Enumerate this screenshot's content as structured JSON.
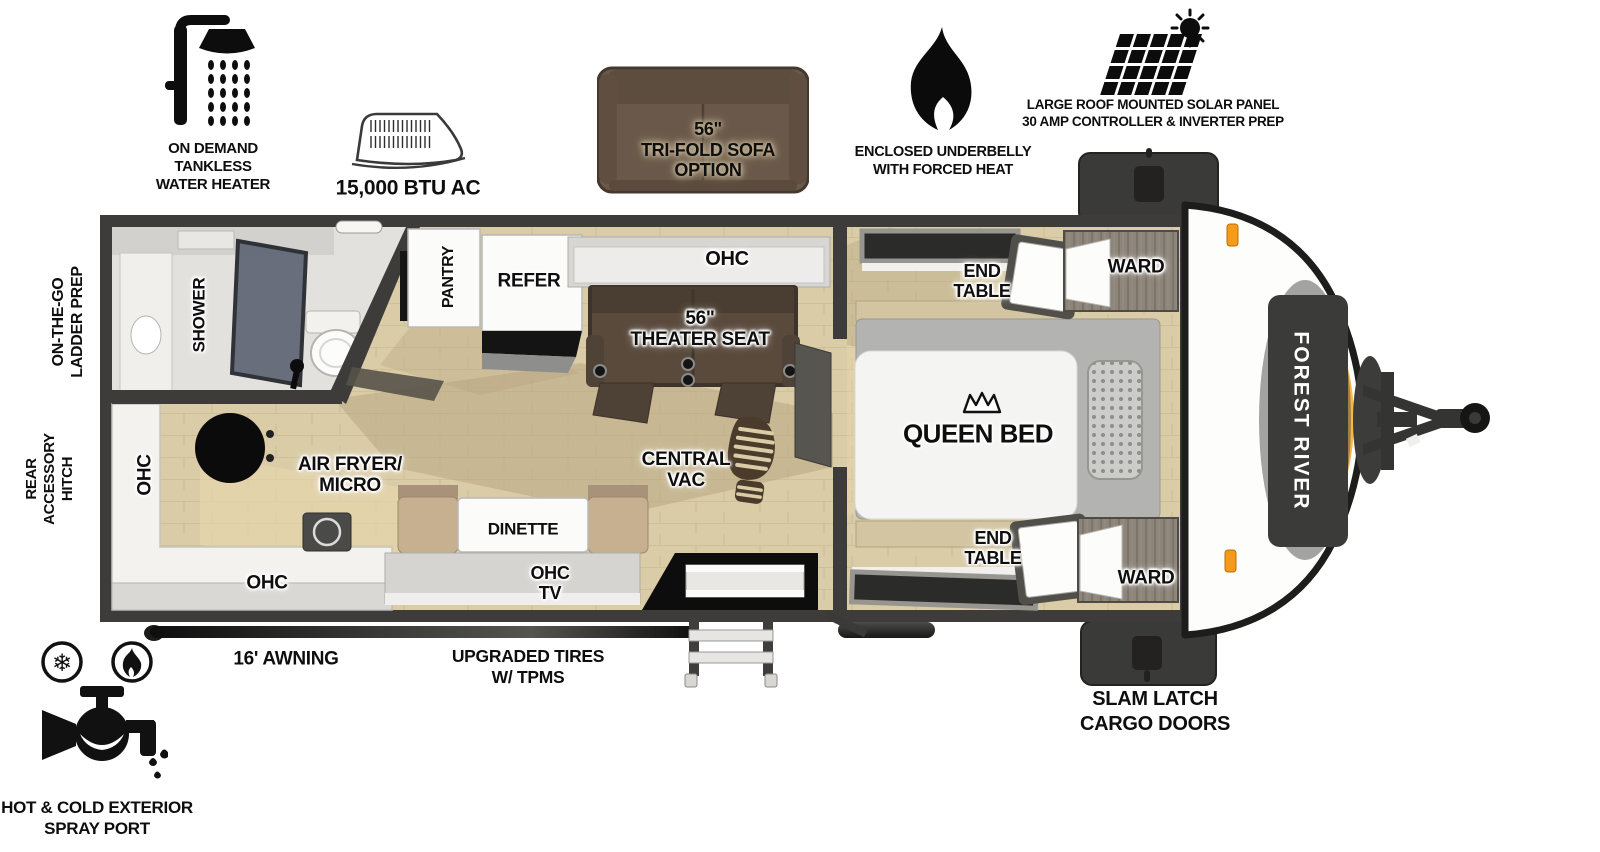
{
  "features_top": [
    {
      "name": "water-heater",
      "label": "ON DEMAND\nTANKLESS\nWATER HEATER"
    },
    {
      "name": "air-conditioner",
      "label": "15,000 BTU AC"
    },
    {
      "name": "trifold-sofa-option",
      "label": "56\"\nTRI-FOLD SOFA\nOPTION"
    },
    {
      "name": "enclosed-underbelly",
      "label": "ENCLOSED UNDERBELLY\nWITH FORCED HEAT"
    },
    {
      "name": "solar-panel",
      "label": "LARGE ROOF MOUNTED SOLAR PANEL\n30 AMP CONTROLLER & INVERTER PREP"
    }
  ],
  "side_labels": {
    "ladder_prep": "ON-THE-GO\nLADDER PREP",
    "rear_hitch": "REAR\nACCESSORY\nHITCH"
  },
  "rooms": {
    "shower": "SHOWER",
    "pantry": "PANTRY",
    "refer": "REFER",
    "ohc_top": "OHC",
    "theater_seat": "56\"\nTHEATER SEAT",
    "ohc_left": "OHC",
    "air_fryer_micro": "AIR FRYER/\nMICRO",
    "ohc_bottom": "OHC",
    "dinette": "DINETTE",
    "ohc_tv": "OHC\nTV",
    "central_vac": "CENTRAL\nVAC",
    "queen_bed": "QUEEN BED",
    "end_table_top": "END\nTABLE",
    "ward_top": "WARD",
    "end_table_bottom": "END\nTABLE",
    "ward_bottom": "WARD"
  },
  "brand_badge": "FOREST RIVER",
  "bottom_labels": {
    "awning": "16' AWNING",
    "tires": "UPGRADED TIRES\nW/ TPMS",
    "cargo_doors": "SLAM LATCH\nCARGO DOORS",
    "spray_port": "HOT & COLD EXTERIOR\nSPRAY PORT"
  },
  "colors": {
    "wall": "#3d3c3a",
    "floor": "#d9cca7",
    "accent_orange": "#f49b1c",
    "theater_brown": "#594a3c",
    "sofa_brown": "#6a594a"
  }
}
